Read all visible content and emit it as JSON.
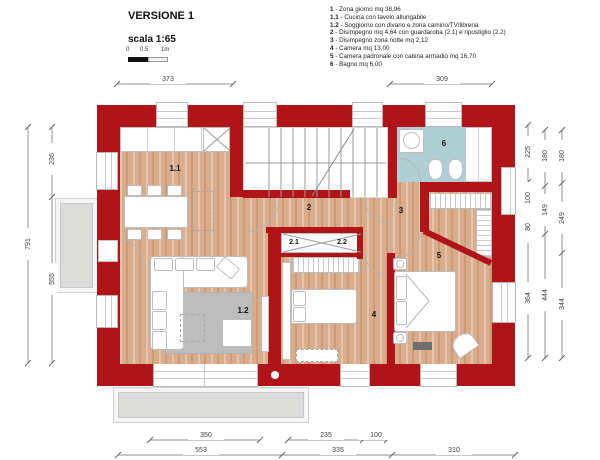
{
  "header": {
    "title": "VERSIONE 1",
    "scale": "scala 1:65"
  },
  "scalebar": [
    "0",
    "0.5",
    "1m"
  ],
  "legend": [
    {
      "num": "1",
      "text": "- Zona giorno mq 38,96"
    },
    {
      "num": "1.1",
      "text": "- Cucina con tavolo allungabile"
    },
    {
      "num": "1.2",
      "text": "- Soggiorno con divano e zona camino/TV/libreria"
    },
    {
      "num": "2",
      "text": "- Disimpegno mq 4,64 con guardaroba (2.1) e ripostiglio (2.2)"
    },
    {
      "num": "3",
      "text": "- Disimpegno zona notte mq 2,12"
    },
    {
      "num": "4",
      "text": "- Camera mq 13,00"
    },
    {
      "num": "5",
      "text": "- Camera padronale con cabina armadio mq 16,70"
    },
    {
      "num": "6",
      "text": "- Bagno mq 6,00"
    }
  ],
  "rooms": {
    "kitchen": "1.1",
    "living": "1.2",
    "hall": "2",
    "wardrobe": "2.1",
    "storage": "2.2",
    "hall_night": "3",
    "bedroom": "4",
    "master": "5",
    "bath": "6"
  },
  "dims": {
    "top": [
      "373",
      "309"
    ],
    "left": [
      "791",
      "236",
      "555"
    ],
    "right1": [
      "225",
      "100",
      "80",
      "364"
    ],
    "right2": [
      "180",
      "149",
      "444"
    ],
    "right3": [
      "180",
      "249",
      "344"
    ],
    "bottom1": [
      "350",
      "235",
      "100"
    ],
    "bottom2": [
      "553",
      "335",
      "310"
    ]
  },
  "colors": {
    "wall_red": "#b01318",
    "wood_floor": "#d9ad8c",
    "bath_floor": "#aed0d5",
    "rug_gray": "#bdbdbd",
    "balcony_gray": "#dcdcda"
  }
}
